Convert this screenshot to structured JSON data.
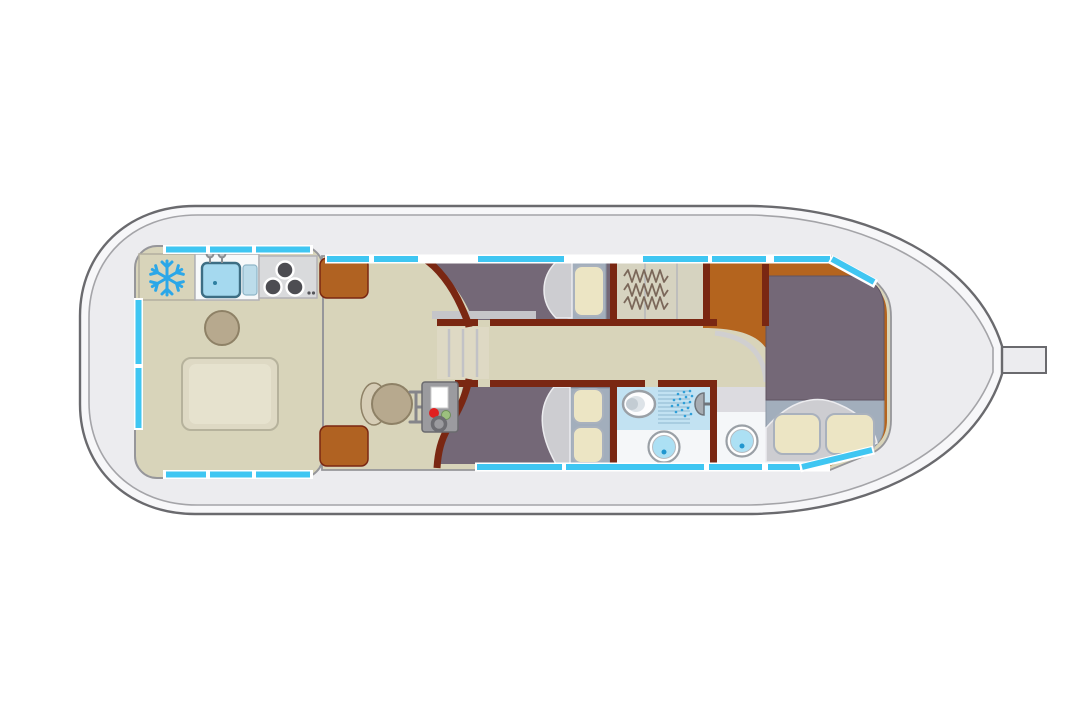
{
  "diagram": {
    "type": "boat-floorplan-top-view",
    "orientation": "bow-right-stern-left",
    "regions": [
      {
        "name": "stern-deck"
      },
      {
        "name": "saloon-galley",
        "fixtures": [
          "fridge",
          "sink",
          "stove",
          "stool",
          "dinette-table"
        ]
      },
      {
        "name": "wheelhouse",
        "fixtures": [
          "helm-seat",
          "steering-column",
          "control-panel",
          "storage-lockers"
        ]
      },
      {
        "name": "companionway-stairs"
      },
      {
        "name": "corridor"
      },
      {
        "name": "port-cabin",
        "fixtures": [
          "berth",
          "pillow"
        ]
      },
      {
        "name": "wardrobe",
        "fixtures": [
          "hanging-rails"
        ]
      },
      {
        "name": "starboard-cabin",
        "fixtures": [
          "berth",
          "pillow",
          "pillow"
        ]
      },
      {
        "name": "shower-room",
        "fixtures": [
          "toilet",
          "shower",
          "washbasin"
        ]
      },
      {
        "name": "washroom",
        "fixtures": [
          "washbasin"
        ]
      },
      {
        "name": "bow-cabin",
        "fixtures": [
          "double-bed",
          "pillow",
          "pillow"
        ]
      },
      {
        "name": "bow-deck",
        "fixtures": [
          "bow-fitting"
        ]
      }
    ],
    "window_strips": "cyan segments along cabin perimeter"
  },
  "colors": {
    "hull_fill": "#ececef",
    "hull_band": "#f7f7f9",
    "hull_line": "#6a6a6e",
    "deck_line": "#a4a4a8",
    "cabin_stroke": "#96969a",
    "floor_beige": "#d8d4ba",
    "table_fill": "#ded9c4",
    "table_hi": "#e6e2ce",
    "table_stroke": "#b6b29c",
    "wall_brown": "#7a2712",
    "locker_orange": "#b06222",
    "bow_floor": "#b4641e",
    "cabin_mauve": "#746877",
    "sheet_gray": "#cdcdd1",
    "pillow_cream": "#ece5c4",
    "pillow_stroke": "#a9b1bd",
    "bed_base": "#a2aebc",
    "window_cyan": "#3fc6f2",
    "shower_floor": "#c2e2f2",
    "white_room": "#f5f7f9",
    "basin_blue": "#ace0f4",
    "basin_dot": "#2196cf",
    "spray_blue": "#2f9fd8",
    "grid_blue": "#8fb8d0",
    "fixture_gray": "#d9dadc",
    "burner_dark": "#4d4d52",
    "snowflake": "#2ba7e8",
    "sink_blue": "#a5d9ef",
    "sink_stroke": "#3d6e84",
    "seat_tan": "#b7a98e",
    "seat_back": "#d6cdb6",
    "seat_stroke": "#8e8166",
    "panel_gray": "#9b9b9f",
    "red_dot": "#e02020",
    "green_dot": "#9cc07e",
    "toilet_inner": "#dde3e8",
    "hanger": "#7b685a",
    "oval_shadow": "#cfced3"
  }
}
